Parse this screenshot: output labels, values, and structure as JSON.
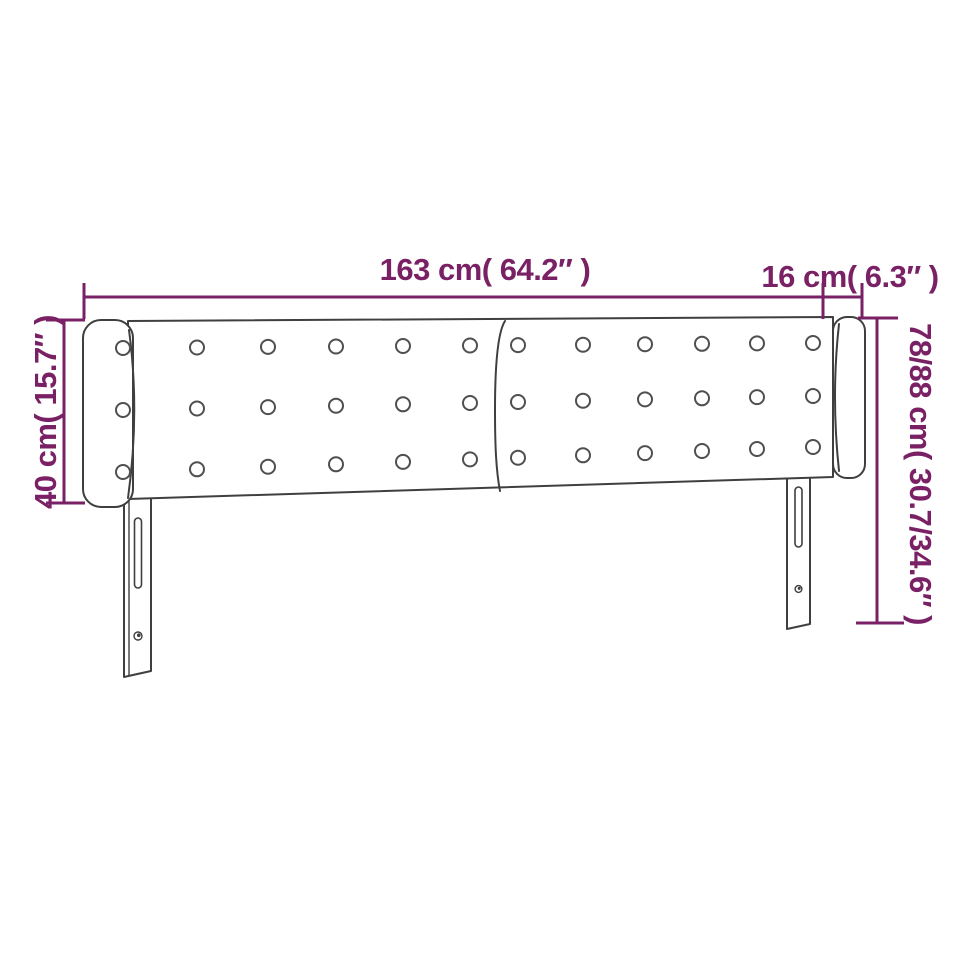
{
  "figure": {
    "name": "headboard-with-ears-dimension-diagram",
    "labels": {
      "width": "163 cm( 64.2″ )",
      "ear_width": "16 cm( 6.3″ )",
      "ear_height": "40 cm( 15.7″ )",
      "total_height": "78/88 cm( 30.7/34.6″ )"
    },
    "colors": {
      "dimension": "#7a2166",
      "outline": "#3f3f3f",
      "button": "#4f4f4f"
    },
    "tufting": {
      "rows": 3,
      "columns": 12
    }
  }
}
